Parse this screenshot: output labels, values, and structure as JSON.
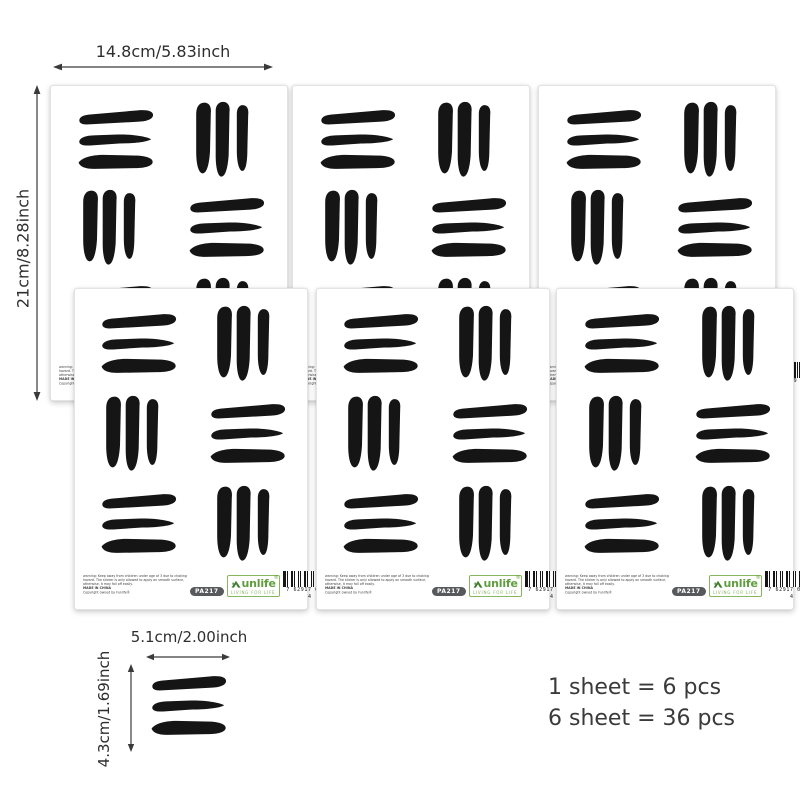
{
  "annotations": {
    "sheet_width_label": "14.8cm/5.83inch",
    "sheet_height_label": "21cm/8.28inch",
    "piece_width_label": "5.1cm/2.00inch",
    "piece_height_label": "4.3cm/1.69inch",
    "pcs_line_1": "1 sheet = 6 pcs",
    "pcs_line_2": "6 sheet = 36 pcs"
  },
  "sheet_footer": {
    "warning_line_1": "warning: Keep away from children under age of 3 due to choking",
    "warning_line_2": "hazard. The sticker is only allowed to apply on smooth surface,",
    "warning_line_3": "otherwise, it may fall off easily.",
    "made_in": "MADE IN CHINA",
    "copyright": "Copyright owned by Funlife®",
    "sku_badge": "PA217",
    "brand": "unlife",
    "registered": "®",
    "tagline": "LIVING FOR LIFE",
    "barcode_digits": "7 62917 06189 4"
  },
  "icons": {
    "brand_logo": "house-roof-icon",
    "dimension_arrows": "double-headed-arrow-icon"
  },
  "colors": {
    "stroke_ink": "#151515",
    "logo_green": "#5f9e3e",
    "logo_green_light": "#86b65e",
    "badge_gray": "#58595b",
    "text_dark": "#3a3a3a"
  },
  "counts_meta": {
    "sheets_shown": 6,
    "groups_per_sheet": 6
  }
}
